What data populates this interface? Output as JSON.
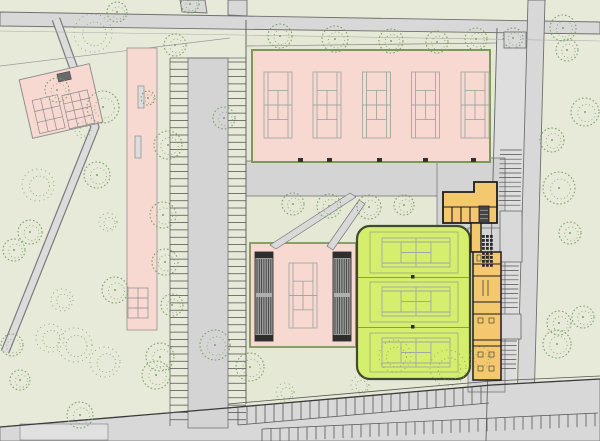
{
  "meta": {
    "kind": "architectural-site-plan",
    "subject": "tennis-facility"
  },
  "canvas": {
    "w": 600,
    "h": 441
  },
  "colors": {
    "bg": "#e7ead9",
    "bg_complex": "#e4e8d4",
    "road": "#d8d8d8",
    "road_gray": "#d4d4d5",
    "sidewalk": "#dedede",
    "edge": "#6f6f6f",
    "edge_dark": "#3a3a3a",
    "thin": "#9a9a9a",
    "pink": "#f8d9d1",
    "olive": "#7b9a58",
    "court_line": "#a3a7a3",
    "green_bldg": "#d6ee6e",
    "green_bldg_edge": "#404b2e",
    "indoor_line": "#8f9c78",
    "surround_line": "#9aa685",
    "orange": "#f4c86e",
    "wall": "#1c1c1c",
    "stand_bg": "#9b9b9b",
    "stand_line": "#383838",
    "stand_cap": "#2e2e2e",
    "tree": "#7fa06b",
    "tick": "#4f4f4f"
  },
  "roads": {
    "complex_bg": [
      [
        246,
        36
      ],
      [
        497,
        32
      ],
      [
        492,
        387
      ],
      [
        246,
        405
      ]
    ],
    "sidewalk": [
      [
        497,
        28
      ],
      [
        528,
        28
      ],
      [
        514,
        441
      ],
      [
        486,
        441
      ]
    ],
    "top_road": [
      [
        0,
        12
      ],
      [
        600,
        22
      ],
      [
        600,
        34
      ],
      [
        0,
        26
      ]
    ],
    "stub_a": [
      [
        180,
        0
      ],
      [
        205,
        0
      ],
      [
        207,
        13
      ],
      [
        182,
        12
      ]
    ],
    "stub_b": [
      [
        228,
        0
      ],
      [
        247,
        0
      ],
      [
        247,
        16
      ],
      [
        228,
        15
      ]
    ],
    "right_road": [
      [
        528,
        0
      ],
      [
        545,
        0
      ],
      [
        533,
        441
      ],
      [
        516,
        441
      ]
    ],
    "bottom_road": [
      [
        0,
        427
      ],
      [
        227,
        408
      ],
      [
        492,
        385
      ],
      [
        600,
        379
      ],
      [
        600,
        441
      ],
      [
        0,
        441
      ]
    ],
    "aisle": [
      [
        188,
        58
      ],
      [
        228,
        58
      ],
      [
        228,
        428
      ],
      [
        188,
        428
      ]
    ],
    "inner_strip": [
      [
        246,
        161
      ],
      [
        505,
        161
      ],
      [
        505,
        196
      ],
      [
        246,
        196
      ]
    ],
    "gray_right_a": [
      [
        437,
        158
      ],
      [
        505,
        158
      ],
      [
        505,
        232
      ],
      [
        437,
        232
      ]
    ],
    "gray_right_b": [
      [
        468,
        228
      ],
      [
        505,
        228
      ],
      [
        505,
        392
      ],
      [
        468,
        392
      ]
    ],
    "footpath": [
      [
        56,
        19
      ],
      [
        95,
        127
      ],
      [
        5,
        352
      ]
    ],
    "driveway_block": [
      20,
      424,
      88,
      16
    ]
  },
  "lines": {
    "property": [
      [
        0,
        66,
        230,
        38
      ]
    ],
    "west_boundary": [
      246,
      20,
      246,
      404
    ],
    "top_fence": [
      247,
      46,
      497,
      43
    ],
    "east_fence": [
      497,
      28,
      486,
      441
    ],
    "bottom_fence": [
      [
        228,
        404,
        492,
        381
      ],
      [
        228,
        408,
        492,
        385
      ],
      [
        492,
        381,
        600,
        376
      ]
    ],
    "bottom_edge": [
      [
        0,
        427
      ],
      [
        227,
        408
      ],
      [
        492,
        385
      ],
      [
        600,
        379
      ]
    ],
    "road_par": [
      0,
      31,
      600,
      41
    ],
    "lot_top": [
      170,
      58,
      246,
      58
    ],
    "lot_left": [
      170,
      58,
      170,
      426
    ]
  },
  "parking": {
    "left_lot": {
      "tick_left": [
        170,
        188
      ],
      "tick_right": [
        228,
        246
      ],
      "y0": 62,
      "y1": 424,
      "step": 7.3
    },
    "right_bays": {
      "x0": 504,
      "x1": 526,
      "lean": -0.027,
      "groups": [
        [
          150,
          207
        ],
        [
          266,
          311
        ],
        [
          341,
          372
        ]
      ],
      "step": 4.6,
      "blocks": [
        [
          500,
          211,
          22,
          51
        ],
        [
          499,
          314,
          22,
          25
        ],
        [
          504,
          32,
          22,
          16
        ]
      ]
    },
    "bottom_row1": {
      "x0": 238,
      "x1": 489,
      "step": 9,
      "len": 18,
      "edge_y0": 408,
      "edge_x0": 227,
      "slope": 0.0868
    },
    "bottom_row2": {
      "x0": 262,
      "x1": 598,
      "step": 9,
      "len": 13,
      "edge_y0": 429,
      "edge_x0": 262,
      "slope": 0.0473
    }
  },
  "areas": {
    "pink_top": [
      252,
      50,
      238,
      112
    ],
    "pink_center": [
      250,
      243,
      106,
      104
    ],
    "pink_strip": [
      127,
      48,
      30,
      282
    ],
    "strip_rects": [
      [
        138,
        86,
        6,
        22
      ],
      [
        135,
        136,
        6,
        22
      ]
    ],
    "strip_grid": [
      128,
      288,
      20,
      30
    ],
    "small_building": {
      "angle": -13,
      "cx": 61,
      "cy": 101,
      "rect": [
        25,
        71,
        72,
        60
      ],
      "grid1": [
        33,
        94,
        26,
        34,
        3,
        3
      ],
      "grid2": [
        63,
        96,
        26,
        34,
        3,
        4
      ],
      "dark_rect": [
        63,
        74,
        13,
        8
      ]
    },
    "outdoor_courts_x": [
      264,
      313,
      362.5,
      411.5,
      461
    ],
    "outdoor_courts_y": 72,
    "outdoor_court_size": [
      28,
      66
    ],
    "center_court": [
      289,
      263,
      28,
      65
    ],
    "stands": [
      [
        255,
        252,
        18,
        89
      ],
      [
        333,
        252,
        18,
        89
      ]
    ],
    "ramps": [
      [
        [
          350,
          193
        ],
        [
          356,
          197
        ],
        [
          276,
          249
        ],
        [
          270,
          245
        ]
      ],
      [
        [
          359,
          200
        ],
        [
          365,
          204
        ],
        [
          333,
          250
        ],
        [
          327,
          246
        ]
      ]
    ],
    "strip_ticks": [
      298,
      327,
      377,
      423,
      471
    ],
    "green_building": [
      357,
      226,
      113,
      153
    ],
    "indoor_courts": [
      [
        382,
        238,
        68,
        29
      ],
      [
        382,
        287,
        68,
        29
      ],
      [
        382,
        338,
        68,
        29
      ]
    ],
    "indoor_surrounds": [
      [
        370,
        232,
        88,
        41
      ],
      [
        370,
        282,
        88,
        40
      ],
      [
        370,
        333,
        88,
        39
      ]
    ],
    "indoor_sep_y": [
      277.5,
      327.5
    ],
    "indoor_sep_x": [
      358,
      469
    ],
    "net_posts": [
      [
        411,
        275
      ],
      [
        411,
        325
      ]
    ]
  },
  "orange": {
    "top_poly": [
      [
        443,
        192
      ],
      [
        474,
        192
      ],
      [
        474,
        182
      ],
      [
        497,
        182
      ],
      [
        497,
        223
      ],
      [
        443,
        223
      ]
    ],
    "top_walls": [
      [
        443,
        207,
        497,
        207
      ],
      [
        452,
        207,
        452,
        223
      ],
      [
        461,
        207,
        461,
        223
      ],
      [
        470,
        207,
        470,
        223
      ]
    ],
    "stair": [
      479,
      206,
      10,
      17
    ],
    "leg": [
      471,
      223,
      10,
      29
    ],
    "strip": [
      473,
      252,
      28,
      128
    ],
    "strip_walls_y": [
      264,
      276,
      302,
      314,
      340,
      346
    ],
    "text_marks": [
      [
        483,
        280,
        483,
        296
      ],
      [
        488,
        280,
        488,
        296
      ]
    ],
    "furniture": [
      [
        478,
        318,
        5,
        5
      ],
      [
        489,
        318,
        5,
        5
      ],
      [
        478,
        352,
        5,
        5
      ],
      [
        489,
        352,
        5,
        5
      ],
      [
        478,
        366,
        5,
        5
      ],
      [
        489,
        366,
        5,
        5
      ],
      [
        477,
        255,
        4,
        6
      ],
      [
        485,
        255,
        4,
        6
      ]
    ],
    "lockers": [
      {
        "x": 482,
        "y": 235,
        "cols": 3,
        "rows": 4,
        "size": 2.8,
        "gap": 1.2
      },
      {
        "x": 482,
        "y": 252,
        "cols": 3,
        "rows": 4,
        "size": 2.8,
        "gap": 1.2
      }
    ]
  },
  "trees": [
    [
      93,
      33,
      19,
      1
    ],
    [
      117,
      12,
      10,
      0
    ],
    [
      190,
      4,
      9,
      0
    ],
    [
      57,
      90,
      12,
      0
    ],
    [
      103,
      107,
      16,
      0
    ],
    [
      148,
      98,
      7,
      0
    ],
    [
      83,
      130,
      8,
      1
    ],
    [
      175,
      45,
      11,
      0
    ],
    [
      168,
      145,
      14,
      0
    ],
    [
      224,
      118,
      11,
      0
    ],
    [
      163,
      215,
      13,
      0
    ],
    [
      97,
      175,
      13,
      0
    ],
    [
      38,
      185,
      16,
      1
    ],
    [
      108,
      222,
      9,
      1
    ],
    [
      30,
      232,
      12,
      0
    ],
    [
      14,
      250,
      11,
      0
    ],
    [
      115,
      290,
      13,
      0
    ],
    [
      62,
      300,
      11,
      1
    ],
    [
      12,
      345,
      11,
      0
    ],
    [
      165,
      262,
      13,
      0
    ],
    [
      172,
      305,
      11,
      0
    ],
    [
      160,
      357,
      14,
      0
    ],
    [
      20,
      380,
      10,
      0
    ],
    [
      80,
      415,
      13,
      0
    ],
    [
      156,
      375,
      14,
      0
    ],
    [
      215,
      345,
      15,
      0
    ],
    [
      75,
      345,
      17,
      1
    ],
    [
      105,
      362,
      15,
      1
    ],
    [
      50,
      338,
      14,
      1
    ],
    [
      250,
      367,
      14,
      0
    ],
    [
      285,
      392,
      9,
      1
    ],
    [
      360,
      385,
      9,
      1
    ],
    [
      395,
      356,
      16,
      1
    ],
    [
      448,
      368,
      18,
      1
    ],
    [
      480,
      358,
      11,
      1
    ],
    [
      293,
      204,
      11,
      0
    ],
    [
      329,
      206,
      12,
      0
    ],
    [
      369,
      207,
      12,
      0
    ],
    [
      404,
      205,
      10,
      0
    ],
    [
      280,
      36,
      12,
      0
    ],
    [
      335,
      39,
      13,
      0
    ],
    [
      391,
      41,
      12,
      0
    ],
    [
      437,
      42,
      11,
      0
    ],
    [
      476,
      39,
      11,
      0
    ],
    [
      513,
      38,
      10,
      0
    ],
    [
      563,
      28,
      13,
      0
    ],
    [
      567,
      50,
      11,
      0
    ],
    [
      585,
      112,
      14,
      0
    ],
    [
      552,
      140,
      12,
      0
    ],
    [
      559,
      188,
      16,
      0
    ],
    [
      570,
      233,
      11,
      0
    ],
    [
      583,
      317,
      11,
      0
    ],
    [
      559,
      323,
      12,
      0
    ],
    [
      557,
      344,
      14,
      0
    ]
  ]
}
